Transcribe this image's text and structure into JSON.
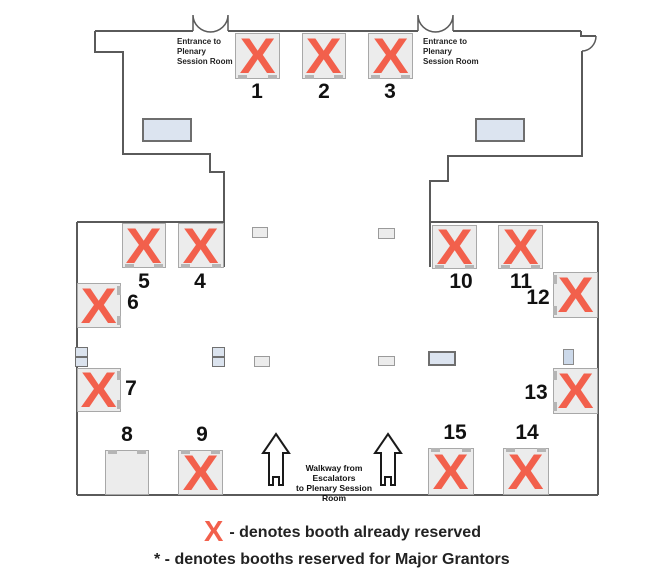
{
  "entrance_label": {
    "line1": "Entrance to",
    "line2": "Plenary",
    "line3": "Session Room"
  },
  "walkway_label": {
    "line1": "Walkway from Escalators",
    "line2": "to Plenary Session Room"
  },
  "legend": {
    "x_symbol": "X",
    "reserved_text": "- denotes booth already reserved",
    "grantors_text": "* - denotes booths reserved for Major Grantors"
  },
  "colors": {
    "reserved_x": "#f2604c",
    "booth_fill": "#ececec",
    "booth_border": "#a8a8a8",
    "wall": "#5a5a5a",
    "table_fill": "#dce4f0",
    "table_border": "#6e6e6e"
  },
  "booths": [
    {
      "number": "1",
      "reserved": true,
      "x": 235,
      "y": 33,
      "w": 45,
      "h": 46,
      "notch": "bottom",
      "label": {
        "x": 237,
        "y": 80
      }
    },
    {
      "number": "2",
      "reserved": true,
      "x": 302,
      "y": 33,
      "w": 44,
      "h": 46,
      "notch": "bottom",
      "label": {
        "x": 304,
        "y": 80
      }
    },
    {
      "number": "3",
      "reserved": true,
      "x": 368,
      "y": 33,
      "w": 45,
      "h": 46,
      "notch": "bottom",
      "label": {
        "x": 370,
        "y": 80
      }
    },
    {
      "number": "4",
      "reserved": true,
      "x": 178,
      "y": 223,
      "w": 46,
      "h": 45,
      "notch": "bottom",
      "label": {
        "x": 180,
        "y": 270
      }
    },
    {
      "number": "5",
      "reserved": true,
      "x": 122,
      "y": 223,
      "w": 44,
      "h": 45,
      "notch": "bottom",
      "label": {
        "x": 124,
        "y": 270
      }
    },
    {
      "number": "6",
      "reserved": true,
      "x": 77,
      "y": 283,
      "w": 44,
      "h": 45,
      "notch": "right",
      "label": {
        "x": 113,
        "y": 291
      }
    },
    {
      "number": "7",
      "reserved": true,
      "x": 77,
      "y": 368,
      "w": 44,
      "h": 44,
      "notch": "right",
      "label": {
        "x": 111,
        "y": 377
      }
    },
    {
      "number": "8",
      "reserved": false,
      "x": 105,
      "y": 450,
      "w": 44,
      "h": 45,
      "notch": "top",
      "label": {
        "x": 107,
        "y": 423
      }
    },
    {
      "number": "9",
      "reserved": true,
      "x": 178,
      "y": 450,
      "w": 45,
      "h": 45,
      "notch": "top",
      "label": {
        "x": 182,
        "y": 423
      }
    },
    {
      "number": "10",
      "reserved": true,
      "x": 432,
      "y": 225,
      "w": 45,
      "h": 44,
      "notch": "bottom",
      "label": {
        "x": 441,
        "y": 270
      }
    },
    {
      "number": "11",
      "reserved": true,
      "x": 498,
      "y": 225,
      "w": 45,
      "h": 44,
      "notch": "bottom",
      "label": {
        "x": 501,
        "y": 270
      }
    },
    {
      "number": "12",
      "reserved": true,
      "x": 553,
      "y": 272,
      "w": 45,
      "h": 46,
      "notch": "left",
      "label": {
        "x": 518,
        "y": 286
      }
    },
    {
      "number": "13",
      "reserved": true,
      "x": 553,
      "y": 368,
      "w": 45,
      "h": 46,
      "notch": "left",
      "label": {
        "x": 516,
        "y": 381
      }
    },
    {
      "number": "14",
      "reserved": true,
      "x": 503,
      "y": 448,
      "w": 46,
      "h": 47,
      "notch": "top",
      "label": {
        "x": 507,
        "y": 421
      }
    },
    {
      "number": "15",
      "reserved": true,
      "x": 428,
      "y": 448,
      "w": 46,
      "h": 47,
      "notch": "top",
      "label": {
        "x": 435,
        "y": 421
      }
    }
  ],
  "furniture": [
    {
      "name": "table-top-left",
      "kind": "rect",
      "x": 142,
      "y": 118,
      "w": 50,
      "h": 24,
      "fill": "#dce4f0",
      "border": "2px solid #6e6e6e"
    },
    {
      "name": "table-top-right",
      "kind": "rect",
      "x": 475,
      "y": 118,
      "w": 50,
      "h": 24,
      "fill": "#dce4f0",
      "border": "2px solid #6e6e6e"
    },
    {
      "name": "floor-marker",
      "kind": "rect",
      "x": 252,
      "y": 227,
      "w": 16,
      "h": 11,
      "fill": "#ececec",
      "border": "1px solid #9a9a9a"
    },
    {
      "name": "floor-marker",
      "kind": "rect",
      "x": 378,
      "y": 228,
      "w": 17,
      "h": 11,
      "fill": "#ececec",
      "border": "1px solid #9a9a9a"
    },
    {
      "name": "utility-stack",
      "kind": "stack",
      "x": 75,
      "y": 347,
      "w": 13,
      "h": 20,
      "fill": "#dbe3ee",
      "border": "1px solid #707070"
    },
    {
      "name": "utility-stack",
      "kind": "stack",
      "x": 212,
      "y": 347,
      "w": 13,
      "h": 20,
      "fill": "#dbe3ee",
      "border": "1px solid #707070"
    },
    {
      "name": "floor-marker",
      "kind": "rect",
      "x": 254,
      "y": 356,
      "w": 16,
      "h": 11,
      "fill": "#ececec",
      "border": "1px solid #9a9a9a"
    },
    {
      "name": "floor-marker",
      "kind": "rect",
      "x": 378,
      "y": 356,
      "w": 17,
      "h": 10,
      "fill": "#ececec",
      "border": "1px solid #9a9a9a"
    },
    {
      "name": "table-center",
      "kind": "rect",
      "x": 428,
      "y": 351,
      "w": 28,
      "h": 15,
      "fill": "#dce4f0",
      "border": "2px solid #6e6e6e"
    },
    {
      "name": "stand",
      "kind": "rect",
      "x": 563,
      "y": 349,
      "w": 11,
      "h": 16,
      "fill": "#ccd9ea",
      "border": "1px solid #8a8a8a"
    }
  ]
}
